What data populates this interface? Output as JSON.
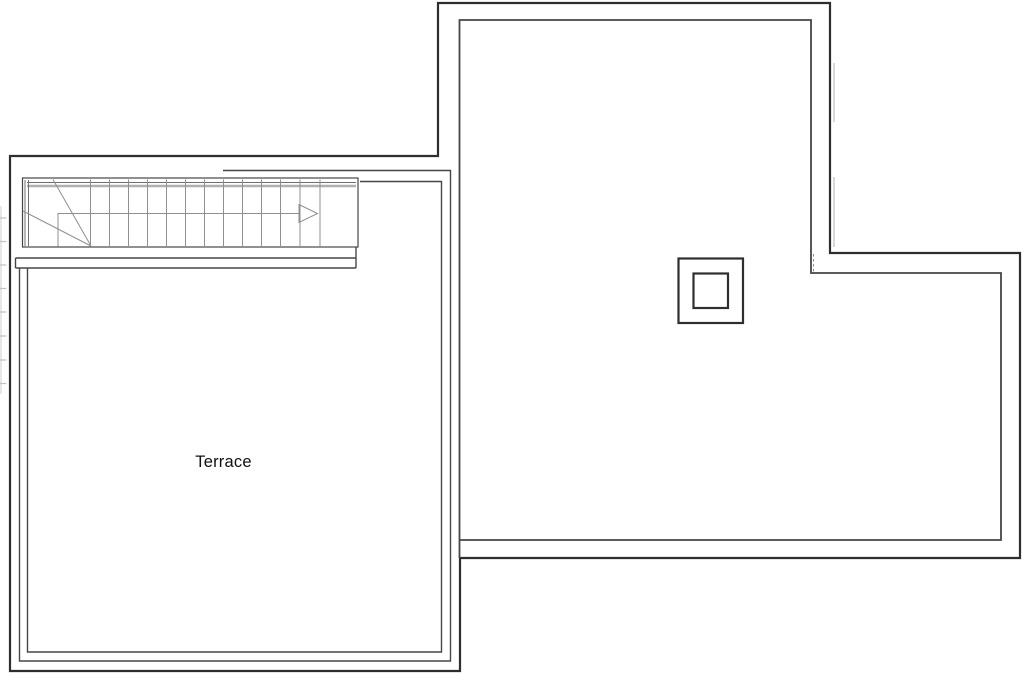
{
  "plan": {
    "type": "floor-plan",
    "room_label": "Terrace",
    "elements": {
      "staircase": "winder-staircase-with-direction-arrow",
      "chimney": "double-square-chimney",
      "terrace": "parapet-bordered-terrace"
    },
    "colors": {
      "background": "#ffffff",
      "wall": "#2e2e2e",
      "wall_light": "#464646",
      "detail": "#8f8f8f",
      "detail_dark": "#6f6f6f",
      "detail_light": "#b0b0b0",
      "faint": "#c3c3c3",
      "text": "#111111"
    }
  }
}
